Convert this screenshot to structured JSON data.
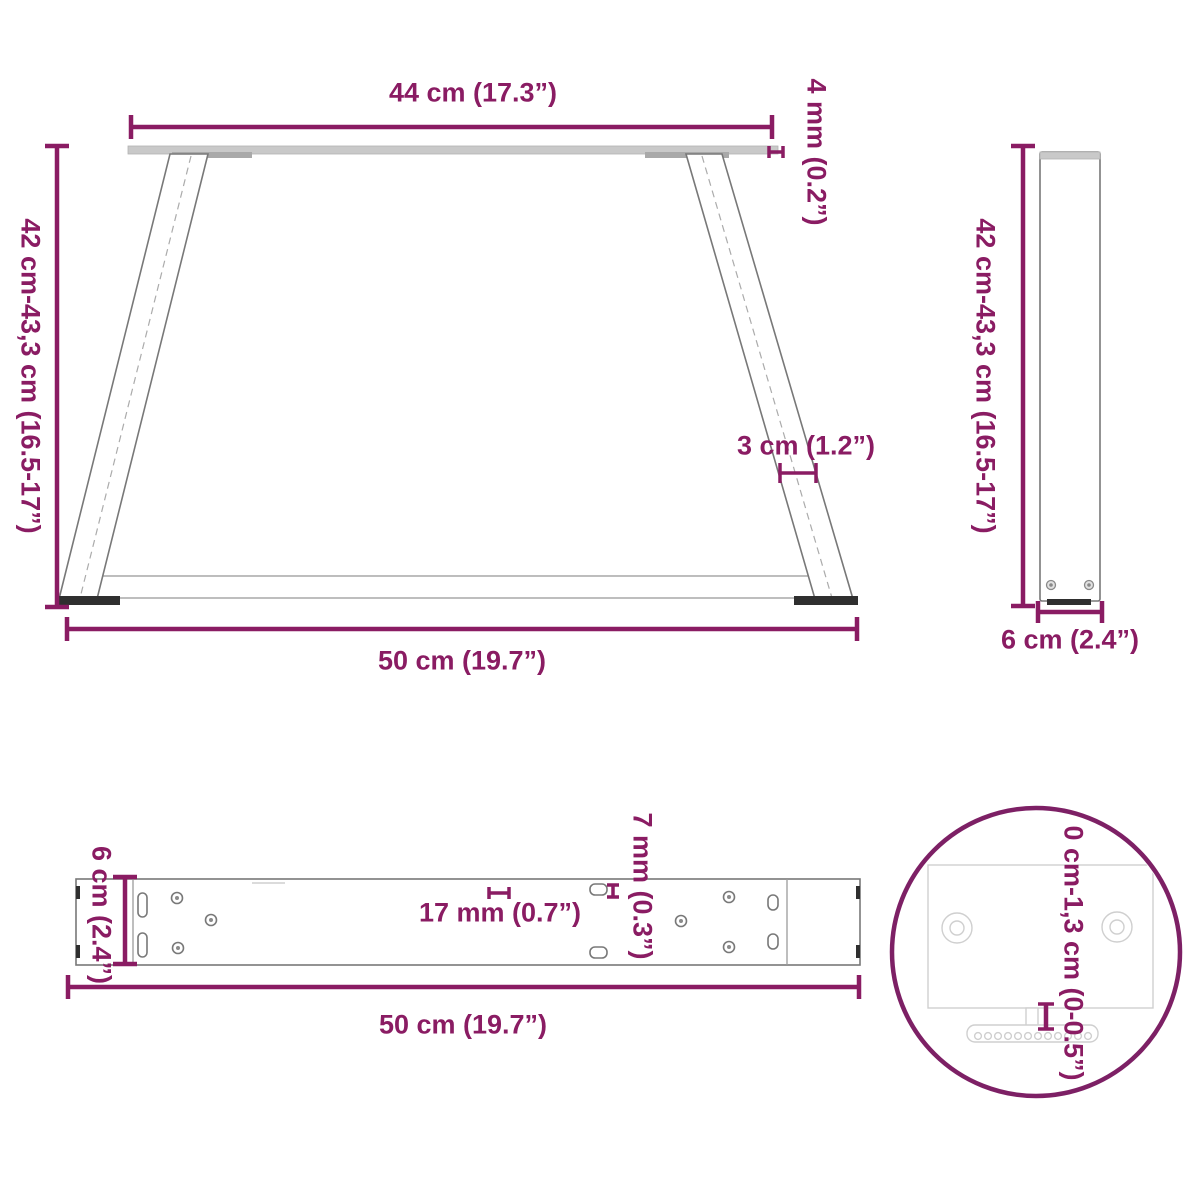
{
  "colors": {
    "accent": "#8a1c63",
    "detail_circle": "#7d2065",
    "drawing_gray": "#787878",
    "drawing_light": "#c9c9c9",
    "dark_fill": "#2f2f2f"
  },
  "views": {
    "front": {
      "top_width_label": "44 cm (17.3”)",
      "thickness_label": "4 mm (0.2”)",
      "height_label": "42 cm-43,3 cm (16.5-17”)",
      "leg_width_label": "3 cm (1.2”)",
      "bottom_width_label": "50 cm (19.7”)"
    },
    "side": {
      "height_label": "42 cm-43,3 cm (16.5-17”)",
      "depth_label": "6 cm (2.4”)"
    },
    "top": {
      "depth_label": "6 cm (2.4”)",
      "hole_spacing_label": "17 mm (0.7”)",
      "slot_height_label": "7 mm (0.3”)",
      "length_label": "50 cm (19.7”)"
    },
    "detail": {
      "adjustment_label": "0 cm-1,3 cm (0-0.5”)"
    }
  }
}
